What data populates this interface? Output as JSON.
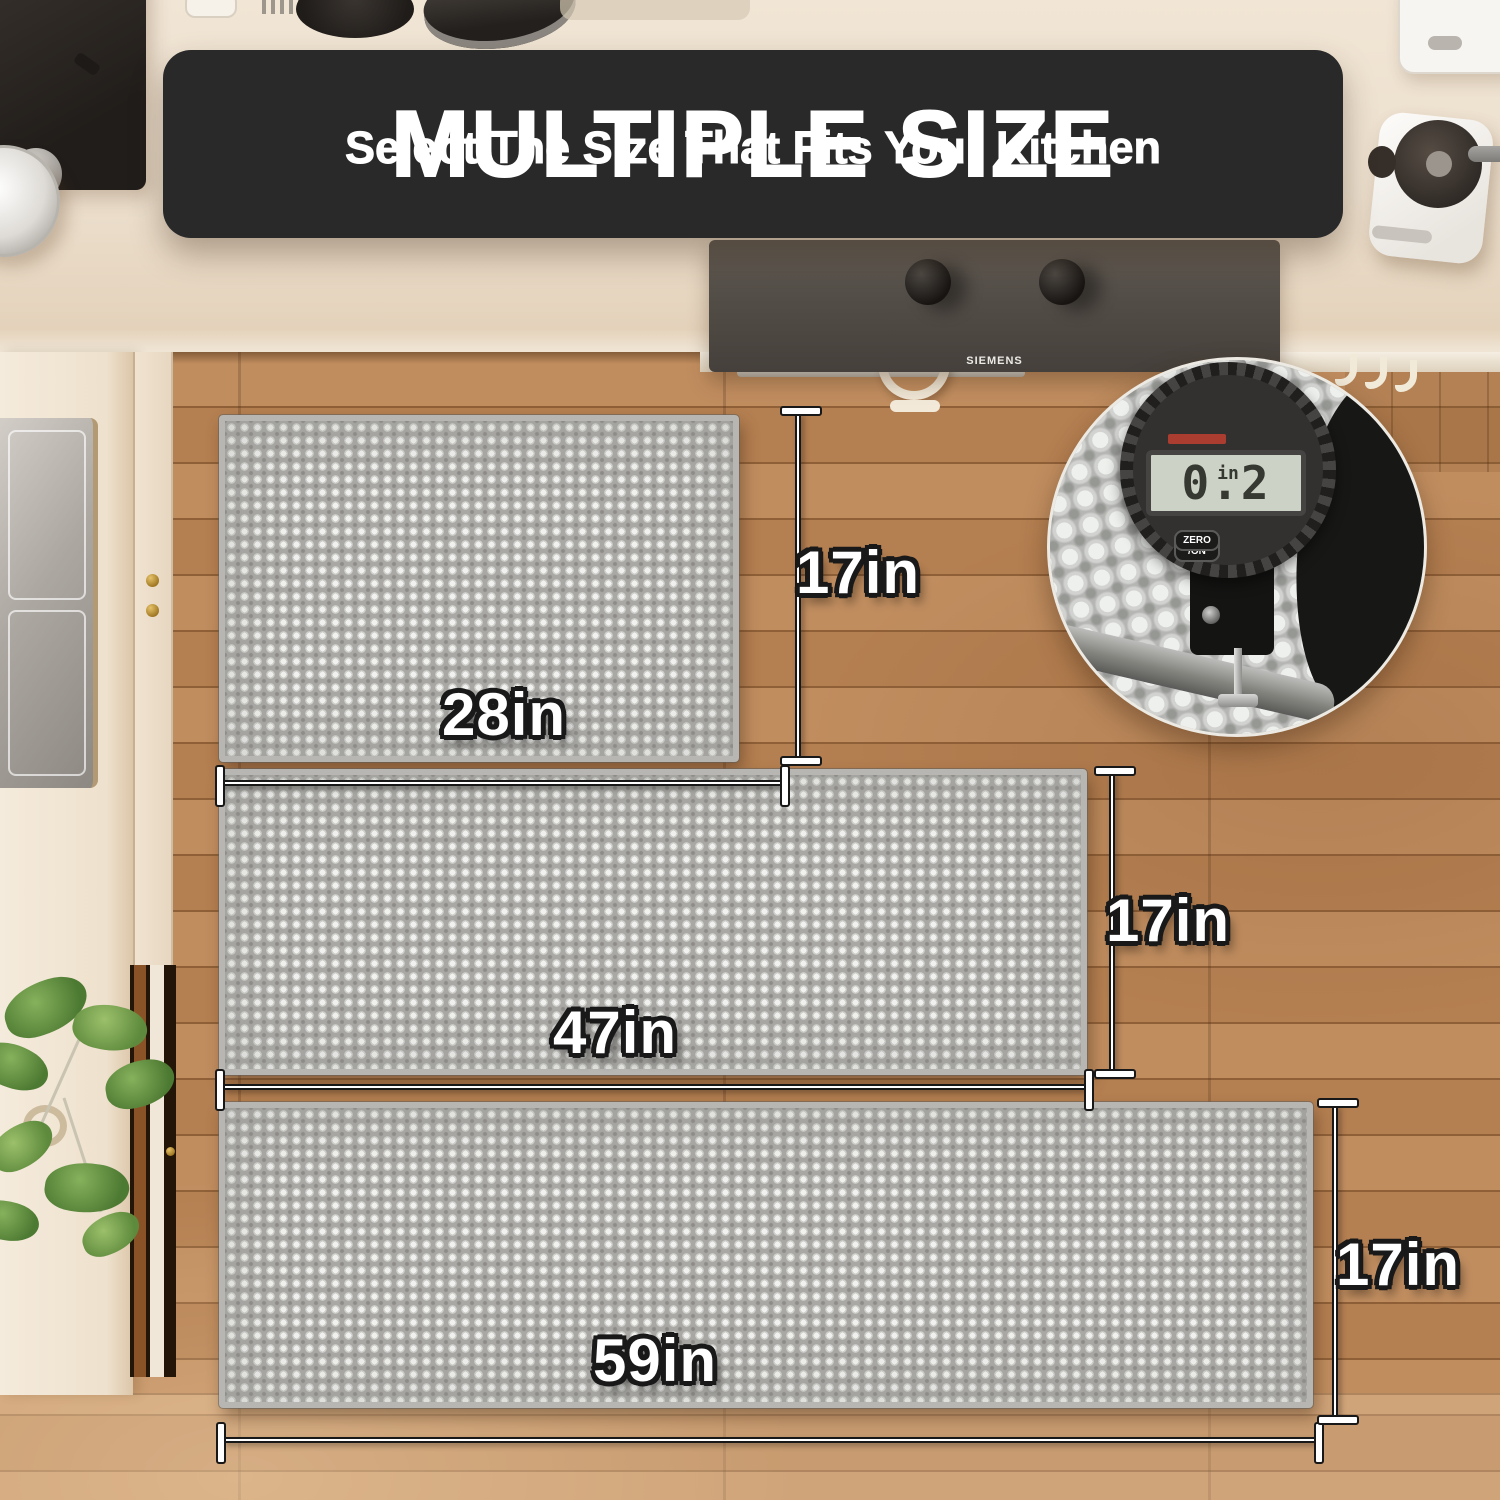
{
  "banner": {
    "title": "MULTIPLE SIZE",
    "subtitle": "Select The Size That Fits Your Kitchen"
  },
  "stove": {
    "brand": "SIEMENS"
  },
  "mats": [
    {
      "width_label": "28in",
      "height_label": "17in"
    },
    {
      "width_label": "47in",
      "height_label": "17in"
    },
    {
      "width_label": "59in",
      "height_label": "17in"
    }
  ],
  "gauge": {
    "display_value": "0.2",
    "display_unit": "in",
    "buttons": [
      "inch\n/mm",
      "OFF\n/ON",
      "ZERO"
    ]
  },
  "colors": {
    "banner_bg": "#29292a",
    "mat_gray": "#a9a8a5",
    "mat_check": "#f1f1ef",
    "wood_floor": "#b88456",
    "counter_cream": "#eee2d0",
    "lcd_green": "#ccd2c6",
    "label_text": "#ffffff",
    "label_outline": "#181818"
  }
}
